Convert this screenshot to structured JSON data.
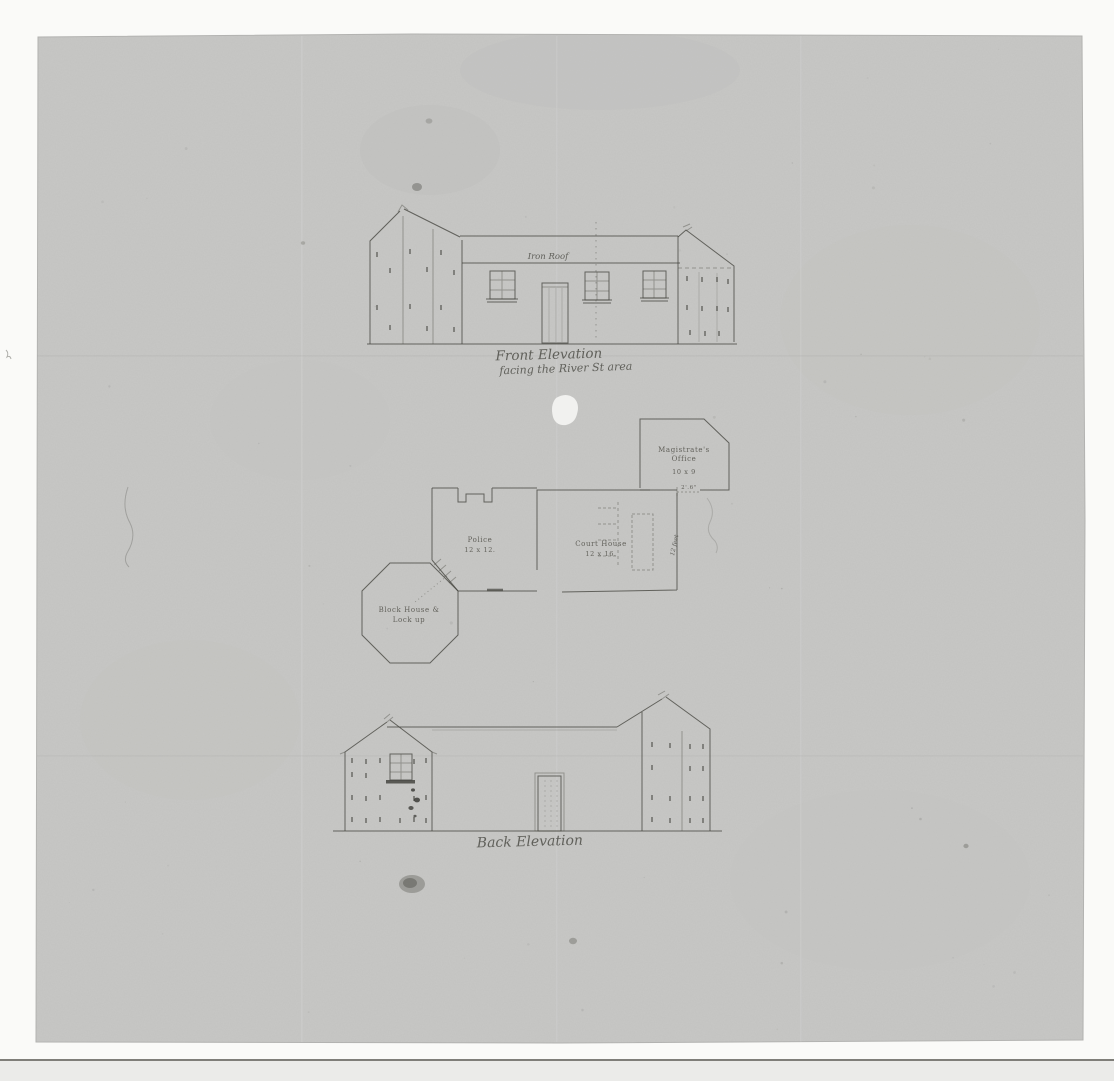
{
  "front_elevation": {
    "roof_label": "Iron Roof",
    "title": "Front Elevation",
    "subtitle": "facing the River St area"
  },
  "floor_plan": {
    "magistrates_office": {
      "label_line1": "Magistrate's",
      "label_line2": "Office",
      "dimensions": "10 x 9"
    },
    "police_room": {
      "label": "Police",
      "dimensions": "12 x 12."
    },
    "court_house": {
      "label": "Court House",
      "dimensions": "12 x 16."
    },
    "block_house": {
      "label_line1": "Block House &",
      "label_line2": "Lock up"
    },
    "annotations": {
      "door_width": "2'.6\"",
      "wall_length": "12 feet"
    }
  },
  "back_elevation": {
    "title": "Back Elevation"
  }
}
